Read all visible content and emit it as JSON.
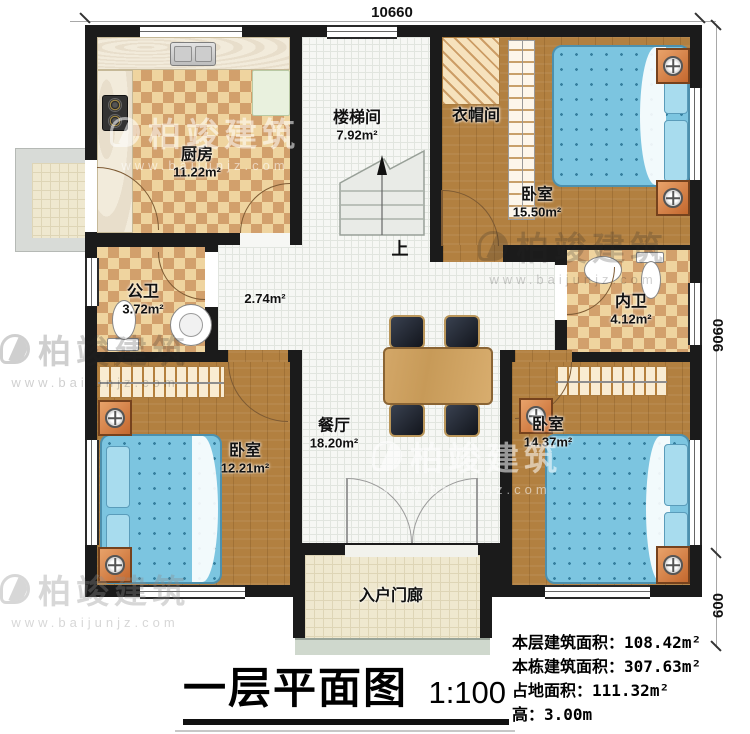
{
  "dimensions": {
    "top": "10660",
    "right": "9060",
    "right_lower": "600"
  },
  "rooms": {
    "kitchen": {
      "name": "厨房",
      "area": "11.22m²"
    },
    "stairwell": {
      "name": "楼梯间",
      "area": "7.92m²"
    },
    "cloakroom": {
      "name": "衣帽间"
    },
    "bedroom_tr": {
      "name": "卧室",
      "area": "15.50m²"
    },
    "public_bath": {
      "name": "公卫",
      "area": "3.72m²"
    },
    "hallway": {
      "area": "2.74m²"
    },
    "ensuite_bath": {
      "name": "内卫",
      "area": "4.12m²"
    },
    "dining": {
      "name": "餐厅",
      "area": "18.20m²"
    },
    "bedroom_bl": {
      "name": "卧室",
      "area": "12.21m²"
    },
    "bedroom_br": {
      "name": "卧室",
      "area": "14.37m²"
    },
    "porch": {
      "name": "入户门廊"
    }
  },
  "stair_direction_label": "上",
  "title_block": {
    "title": "一层平面图",
    "scale": "1:100"
  },
  "stats": [
    {
      "label": "本层建筑面积：",
      "value": "108.42m²"
    },
    {
      "label": "本栋建筑面积：",
      "value": "307.63m²"
    },
    {
      "label": "占地面积：",
      "value": "111.32m²"
    },
    {
      "label": "高：",
      "value": "3.00m"
    }
  ],
  "watermark": {
    "brand": "柏竣建筑",
    "url": "www.baijunjz.com"
  },
  "palette": {
    "wall": "#1b1b1b",
    "wood": "#b28040",
    "checker_a": "#efd49f",
    "checker_b": "#d2a06c",
    "tile_white": "#f6f7f4",
    "porch_tile": "#efe8cf",
    "bed_blue": "#7cc5e0",
    "accent_orange": "#d9854a"
  }
}
